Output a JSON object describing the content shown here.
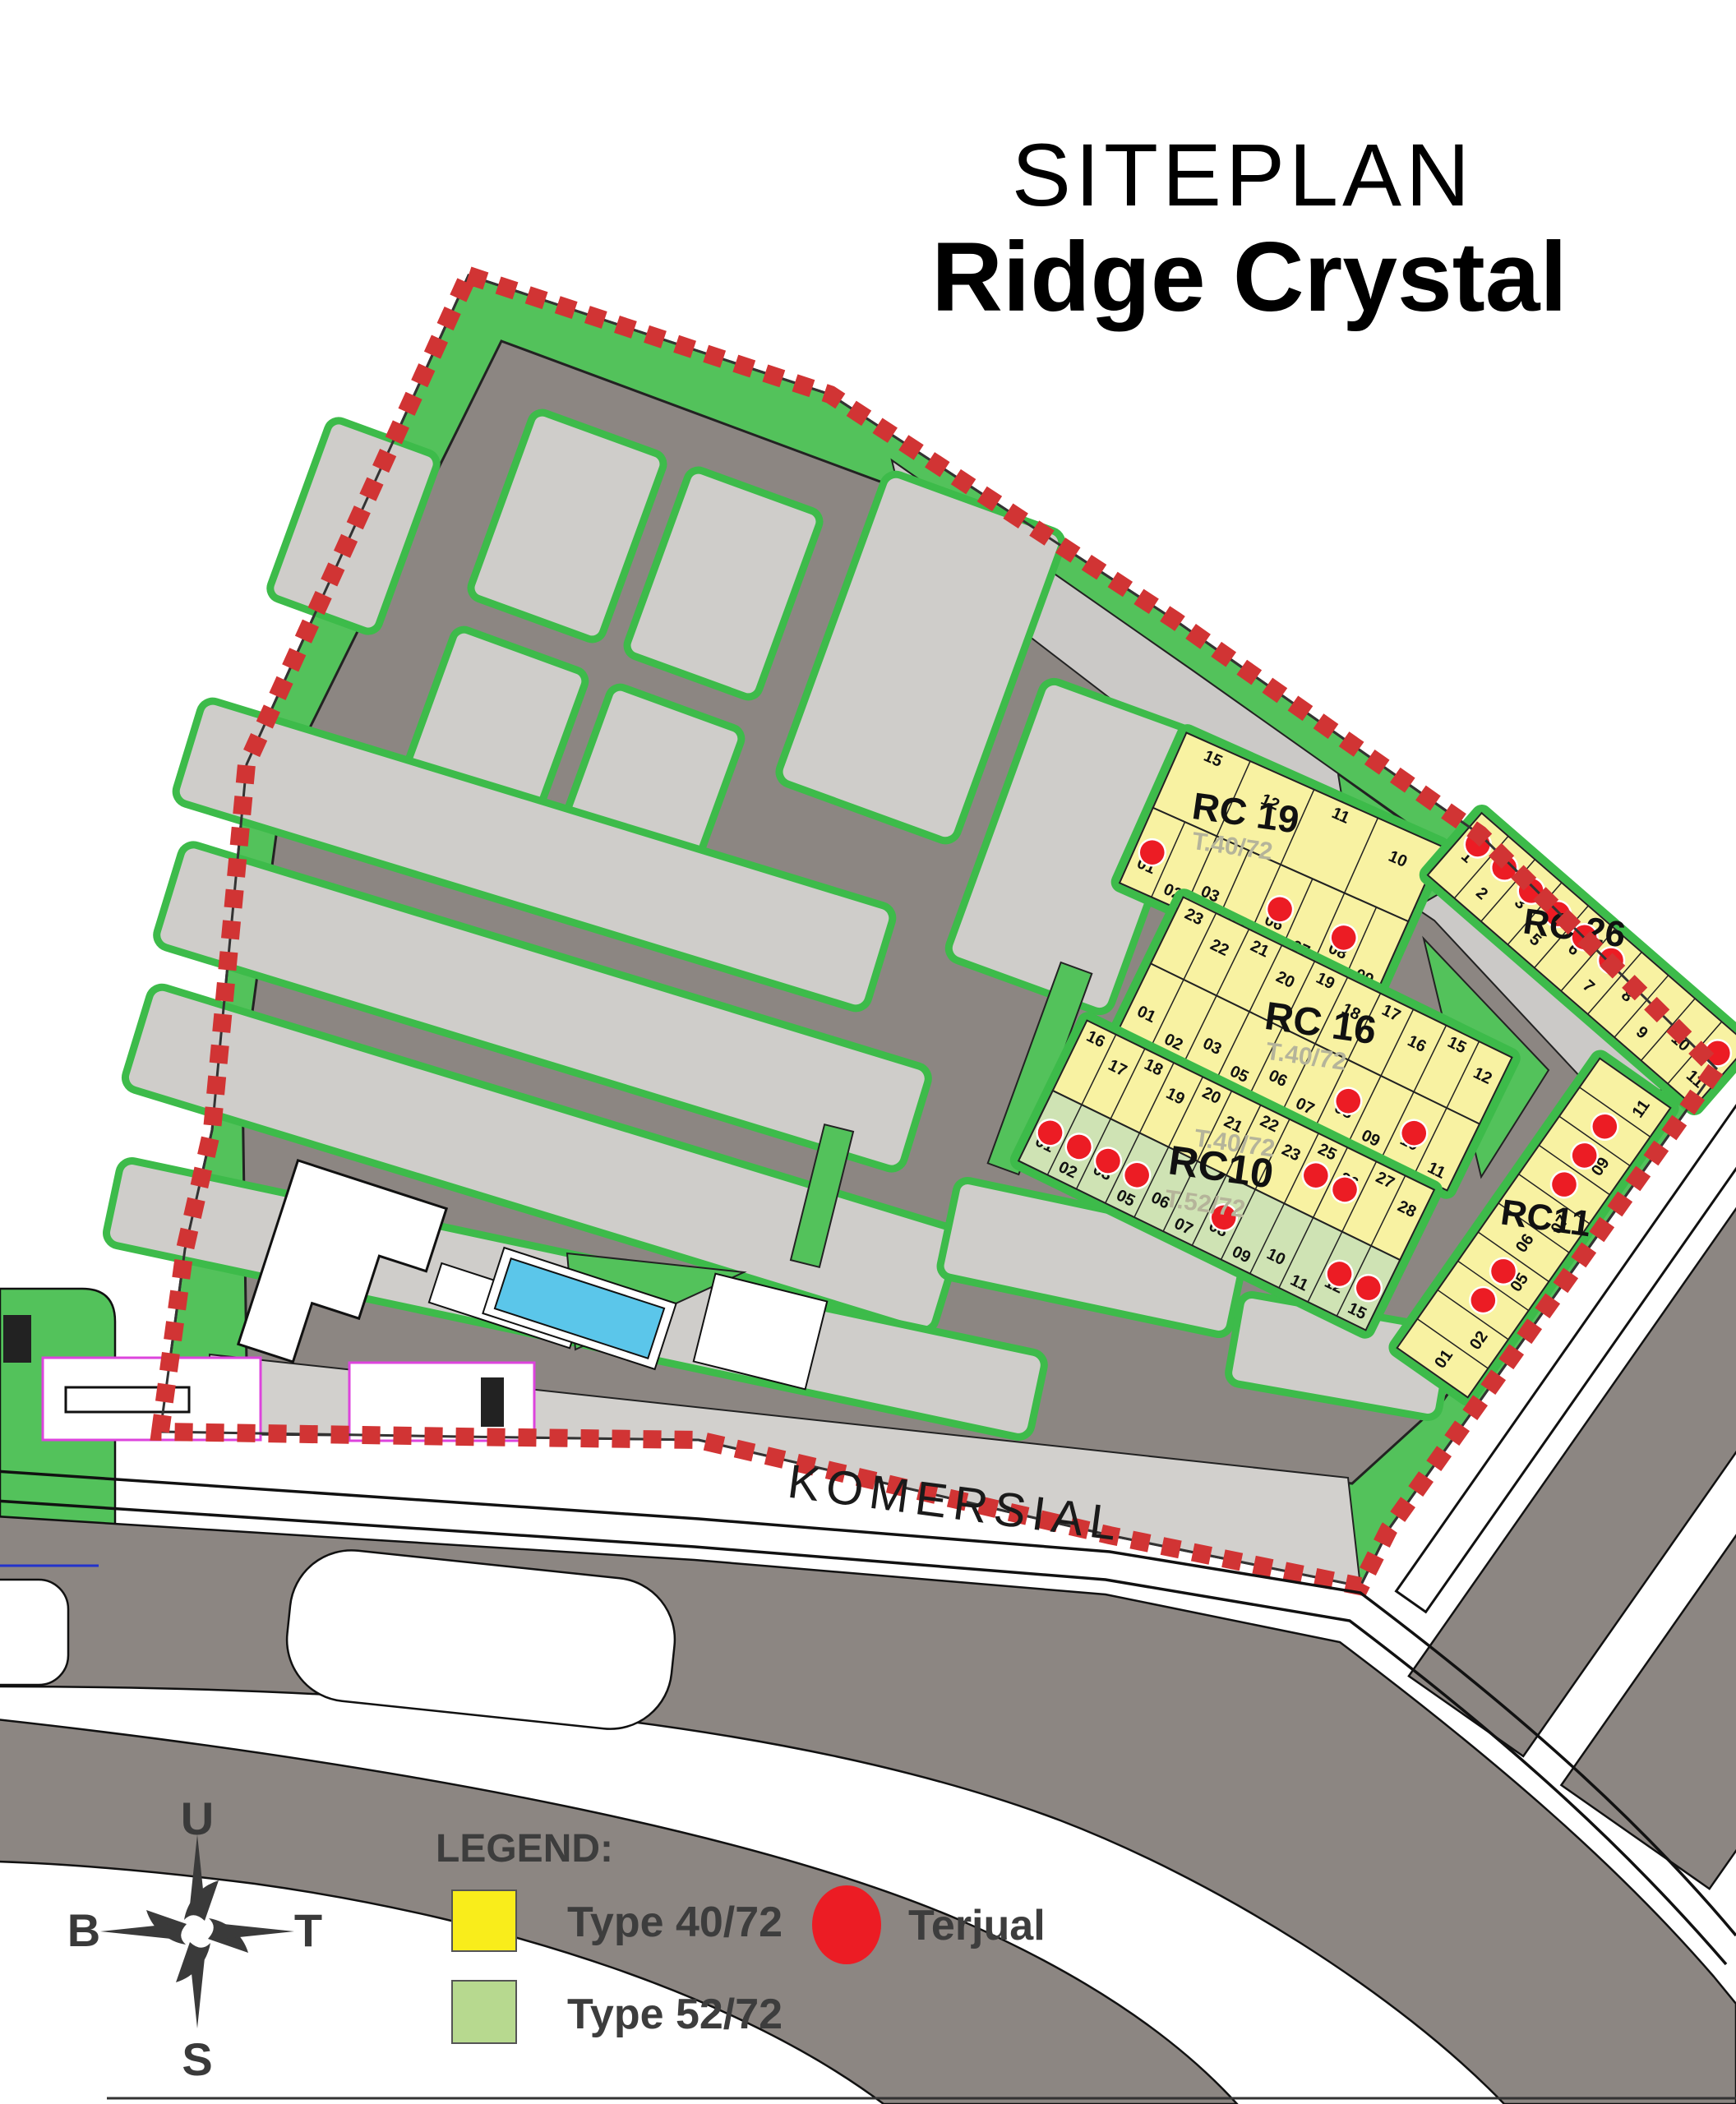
{
  "title": {
    "line1": "SITEPLAN",
    "line2": "Ridge Crystal"
  },
  "map": {
    "komersial_label": "KOMERSIAL",
    "colors": {
      "boundary_dash": "#d13434",
      "road": "#8c8682",
      "block": "#cfcdca",
      "green": "#53c25b",
      "lot_yellow": "#f8f2a2",
      "lot_green": "#cfe3b4",
      "sold_dot": "#ec1c24",
      "pool": "#5bc6ea"
    },
    "clusters": [
      {
        "id": "rc19",
        "name": "RC 19",
        "type_labels": [
          "T.40/72"
        ],
        "rows": [
          {
            "fill": "yellow",
            "side": "top",
            "lots": [
              {
                "n": "15"
              },
              {
                "n": "12"
              },
              {
                "n": "11"
              },
              {
                "n": "10"
              }
            ]
          },
          {
            "fill": "yellow",
            "side": "bottom",
            "lots": [
              {
                "n": "01",
                "sold": true
              },
              {
                "n": "02"
              },
              {
                "n": "03"
              },
              {
                "n": "05"
              },
              {
                "n": "06",
                "sold": true
              },
              {
                "n": "07"
              },
              {
                "n": "08",
                "sold": true
              },
              {
                "n": "09"
              }
            ]
          }
        ]
      },
      {
        "id": "rc16",
        "name": "RC 16",
        "type_labels": [
          "T.40/72"
        ],
        "rows": [
          {
            "fill": "yellow",
            "side": "top",
            "lots": [
              {
                "n": "23"
              },
              {
                "n": "22"
              },
              {
                "n": "21"
              },
              {
                "n": "20"
              },
              {
                "n": "19"
              },
              {
                "n": "18"
              },
              {
                "n": "17"
              },
              {
                "n": "16"
              },
              {
                "n": "15"
              },
              {
                "n": "12"
              }
            ]
          },
          {
            "fill": "yellow",
            "side": "bottom",
            "lots": [
              {
                "n": "01"
              },
              {
                "n": "02"
              },
              {
                "n": "03"
              },
              {
                "n": "05"
              },
              {
                "n": "06"
              },
              {
                "n": "07"
              },
              {
                "n": "08",
                "sold": true
              },
              {
                "n": "09"
              },
              {
                "n": "10",
                "sold": true
              },
              {
                "n": "11"
              }
            ]
          }
        ]
      },
      {
        "id": "rc10",
        "name": "RC10",
        "type_labels": [
          "T.40/72",
          "T.52/72"
        ],
        "rows": [
          {
            "fill": "yellow",
            "side": "top",
            "lots": [
              {
                "n": "16"
              },
              {
                "n": "17"
              },
              {
                "n": "18"
              },
              {
                "n": "19"
              },
              {
                "n": "20"
              },
              {
                "n": "21"
              },
              {
                "n": "22"
              },
              {
                "n": "23"
              },
              {
                "n": "25",
                "sold": true
              },
              {
                "n": "26",
                "sold": true
              },
              {
                "n": "27"
              },
              {
                "n": "28"
              }
            ]
          },
          {
            "fill": "green",
            "side": "bottom",
            "lots": [
              {
                "n": "01",
                "sold": true
              },
              {
                "n": "02",
                "sold": true
              },
              {
                "n": "03",
                "sold": true
              },
              {
                "n": "05",
                "sold": true
              },
              {
                "n": "06"
              },
              {
                "n": "07"
              },
              {
                "n": "08",
                "sold": true
              },
              {
                "n": "09"
              },
              {
                "n": "10"
              },
              {
                "n": "11"
              },
              {
                "n": "12",
                "sold": true
              },
              {
                "n": "15",
                "sold": true
              }
            ]
          }
        ]
      },
      {
        "id": "rc26",
        "name": "RC 26",
        "type_labels": [],
        "rows": [
          {
            "fill": "yellow",
            "side": "mid",
            "lots": [
              {
                "n": "1",
                "sold": true
              },
              {
                "n": "2",
                "sold": true
              },
              {
                "n": "3",
                "sold": true
              },
              {
                "n": "5",
                "sold": true
              },
              {
                "n": "6",
                "sold": true
              },
              {
                "n": "7",
                "sold": true
              },
              {
                "n": "8"
              },
              {
                "n": "9"
              },
              {
                "n": "10"
              },
              {
                "n": "11",
                "sold": true
              }
            ]
          }
        ]
      },
      {
        "id": "rc11",
        "name": "RC11",
        "type_labels": [],
        "rows": [
          {
            "fill": "yellow",
            "side": "mid",
            "lots": [
              {
                "n": "01"
              },
              {
                "n": "02"
              },
              {
                "n": "03",
                "sold": true
              },
              {
                "n": "05",
                "sold": true
              },
              {
                "n": "06"
              },
              {
                "n": "07"
              },
              {
                "n": "08",
                "sold": true
              },
              {
                "n": "09",
                "sold": true
              },
              {
                "n": "10",
                "sold": true
              },
              {
                "n": "11"
              }
            ]
          }
        ]
      }
    ]
  },
  "compass": {
    "north": "U",
    "east": "T",
    "south": "S",
    "west": "B"
  },
  "legend": {
    "heading": "LEGEND:",
    "items": [
      {
        "label": "Type 40/72",
        "color": "#f9ed1b",
        "shape": "square"
      },
      {
        "label": "Type 52/72",
        "color": "#b7d98f",
        "shape": "square"
      },
      {
        "label": "Terjual",
        "color": "#ec1c24",
        "shape": "circle"
      }
    ]
  }
}
